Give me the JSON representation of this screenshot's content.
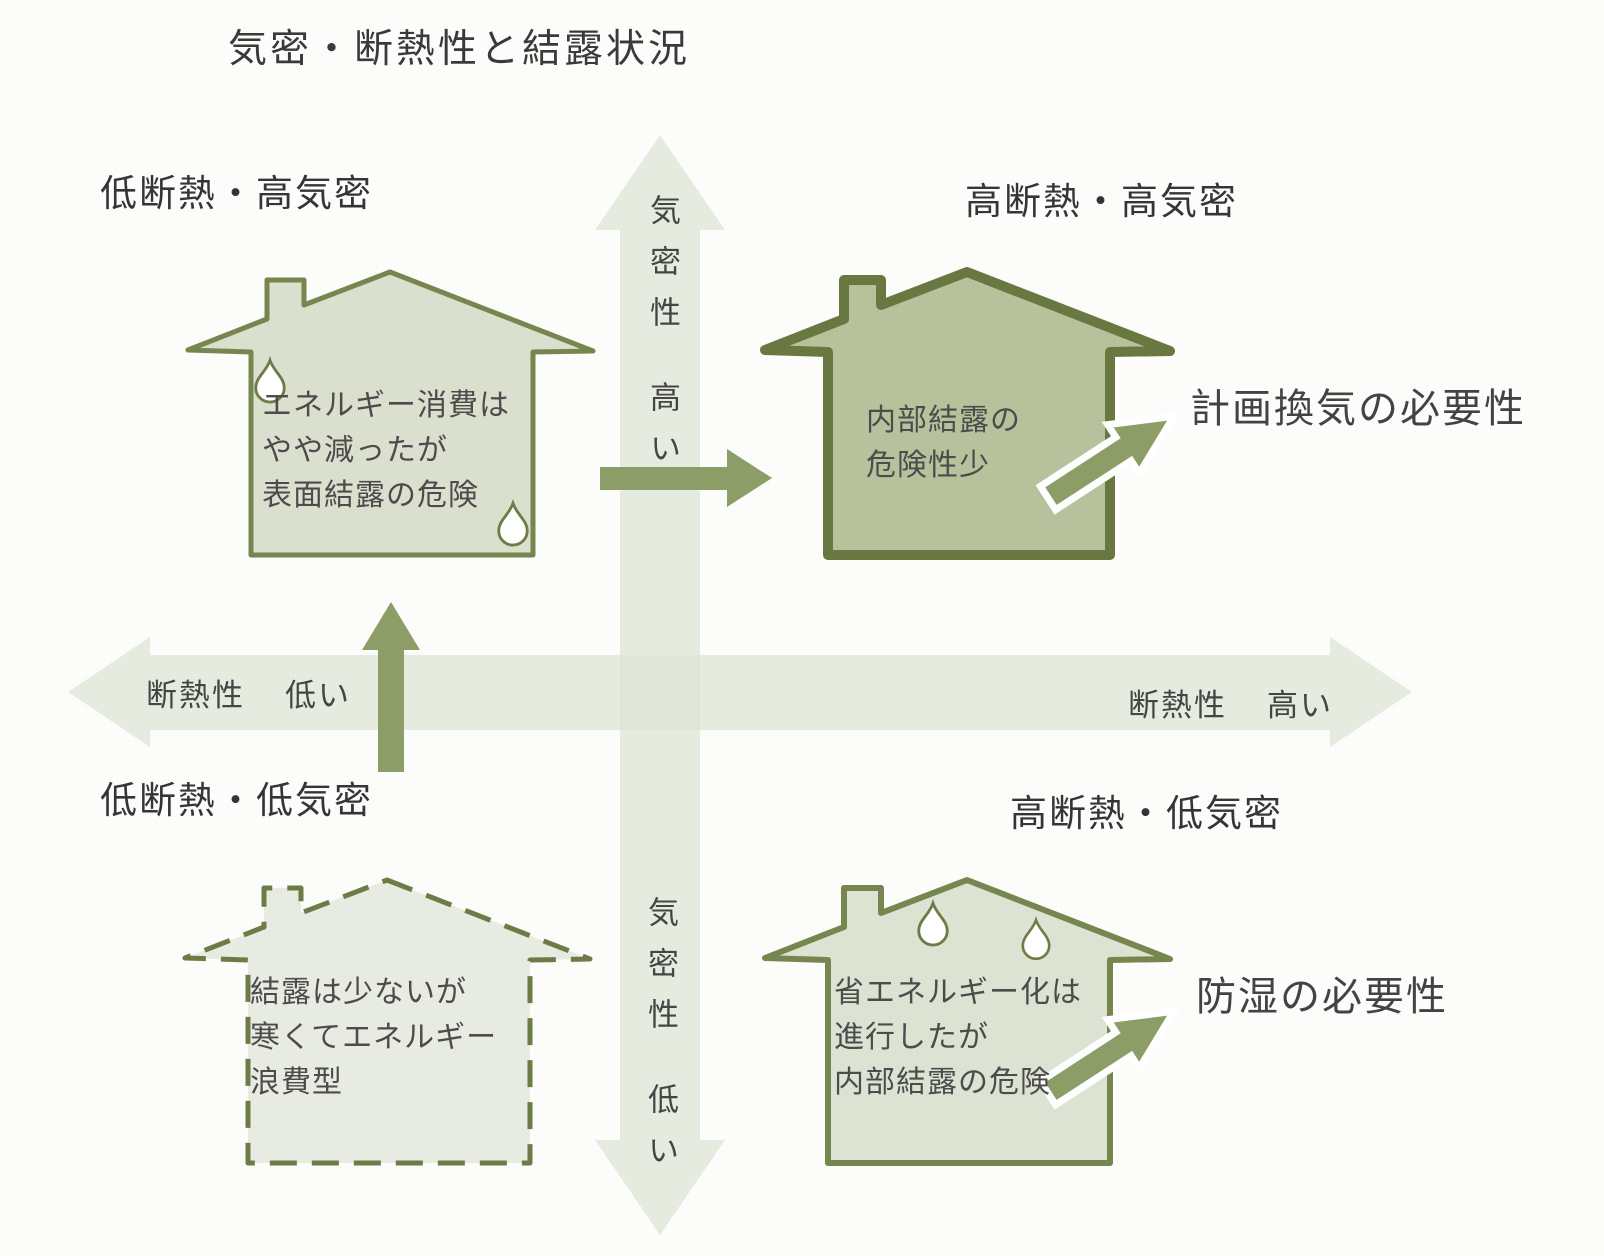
{
  "title": "気密・断熱性と結露状況",
  "axes": {
    "vertical_top": {
      "axis": "気密性",
      "value": "高い"
    },
    "vertical_bottom": {
      "axis": "気密性",
      "value": "低い"
    },
    "horizontal_left": {
      "axis": "断熱性",
      "value": "低い"
    },
    "horizontal_right": {
      "axis": "断熱性",
      "value": "高い"
    }
  },
  "quadrants": {
    "top_left": {
      "label": "低断熱・高気密",
      "house_text": [
        "エネルギー消費は",
        "やや減ったが",
        "表面結露の危険"
      ]
    },
    "top_right": {
      "label": "高断熱・高気密",
      "house_text": [
        "内部結露の",
        "危険性少"
      ],
      "callout": "計画換気の必要性"
    },
    "bottom_left": {
      "label": "低断熱・低気密",
      "house_text": [
        "結露は少ないが",
        "寒くてエネルギー",
        "浪費型"
      ]
    },
    "bottom_right": {
      "label": "高断熱・低気密",
      "house_text": [
        "省エネルギー化は",
        "進行したが",
        "内部結露の危険"
      ],
      "callout": "防湿の必要性"
    }
  },
  "colors": {
    "background": "#fcfcfa",
    "pale_axis_arrow": "#e7ebe0",
    "house_fill_pale": "#dbe0ce",
    "house_fill_dark": "#b7c19c",
    "house_fill_dashed": "#e8ebe2",
    "house_outline": "#76864e",
    "house_outline_dark": "#687840",
    "accent_arrow": "#8d9d68",
    "droplet_fill": "#ffffff",
    "text": "#3c3c3c"
  }
}
